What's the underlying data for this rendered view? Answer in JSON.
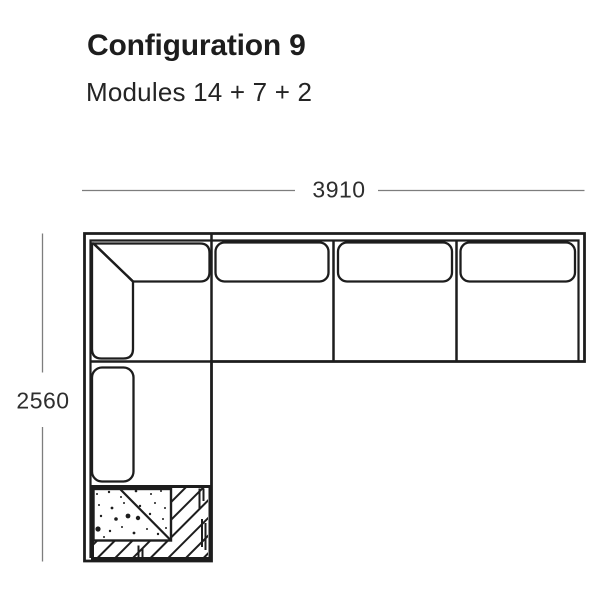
{
  "header": {
    "title": "Configuration 9",
    "subtitle": "Modules 14 + 7 + 2"
  },
  "diagram": {
    "type": "sofa-configuration-floorplan",
    "dimensions": {
      "width_mm": "3910",
      "height_mm": "2560"
    },
    "modules": "14 + 7 + 2",
    "colors": {
      "sofa_line": "#1d1d1d",
      "dimension_line": "#7d7d7d",
      "dimension_text": "#2e2e2e",
      "cushion_fill": "#ffffff",
      "background": "#ffffff"
    }
  }
}
